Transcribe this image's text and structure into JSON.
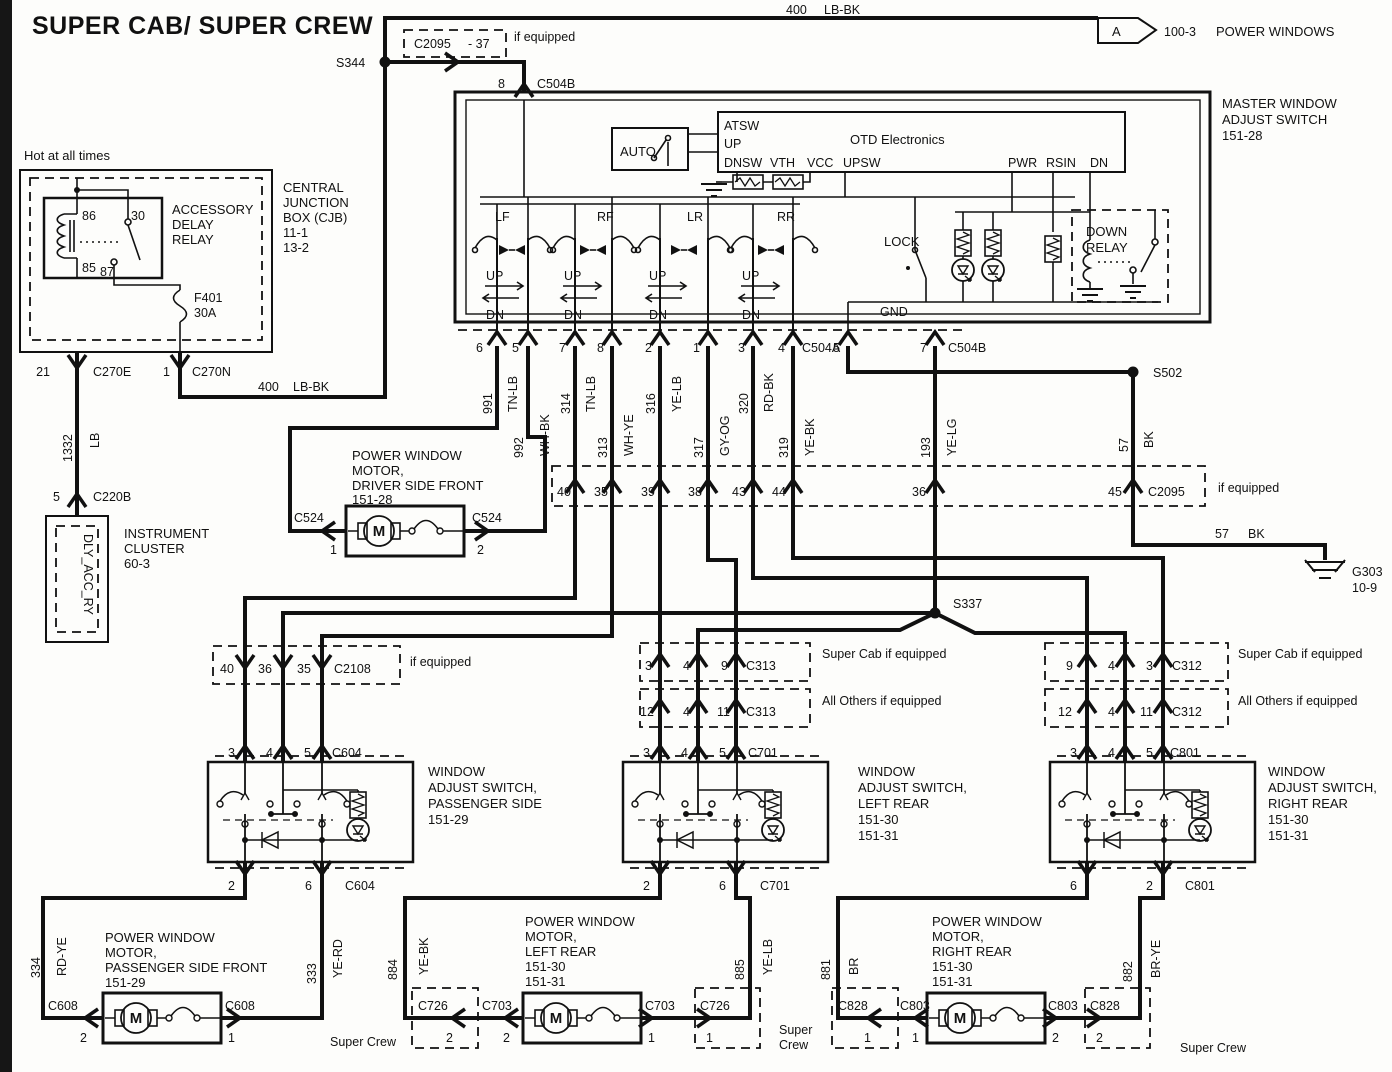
{
  "title": "SUPER CAB/ SUPER CREW",
  "phrases": {
    "hot": "Hot at all times",
    "if_equipped": "if equipped",
    "super_cab": "Super Cab if equipped",
    "all_others": "All Others if equipped",
    "super_crew": "Super Crew",
    "super": "Super",
    "crew": "Crew",
    "power_windows": "POWER WINDOWS",
    "flag": "A",
    "flag_ref": "100-3"
  },
  "splices": {
    "s344": "S344",
    "s502": "S502",
    "s337": "S337"
  },
  "grounds": {
    "g303": "G303",
    "g303_ref": "10-9"
  },
  "connectors": {
    "c2095": "C2095",
    "c2095_pin": "- 37",
    "c504a": "C504A",
    "c504b": "C504B",
    "c270e": "C270E",
    "c270n": "C270N",
    "c220b": "C220B",
    "c524": "C524",
    "c2108": "C2108",
    "c604": "C604",
    "c313": "C313",
    "c701": "C701",
    "c726": "C726",
    "c703": "C703",
    "c312": "C312",
    "c801": "C801",
    "c828": "C828",
    "c803": "C803",
    "c608": "C608"
  },
  "pins": {
    "p1": "1",
    "p2": "2",
    "p3": "3",
    "p4": "4",
    "p5": "5",
    "p6": "6",
    "p7": "7",
    "p8": "8",
    "p9": "9",
    "p11": "11",
    "p12": "12",
    "p21": "21",
    "p35": "35",
    "p36": "36",
    "p38": "38",
    "p39": "39",
    "p40": "40",
    "p43": "43",
    "p44": "44",
    "p45": "45"
  },
  "wires": {
    "w400": "400",
    "c400": "LB-BK",
    "w1332": "1332",
    "c1332": "LB",
    "w991": "991",
    "c991": "TN-LB",
    "w992": "992",
    "c992": "WH-BK",
    "w314": "314",
    "c314": "TN-LB",
    "w313": "313",
    "c313": "WH-YE",
    "w316": "316",
    "c316": "YE-LB",
    "w317": "317",
    "c317": "GY-OG",
    "w320": "320",
    "c320": "RD-BK",
    "w319": "319",
    "c319": "YE-BK",
    "w193": "193",
    "c193": "YE-LG",
    "w57": "57",
    "c57": "BK",
    "w334": "334",
    "c334": "RD-YE",
    "w333": "333",
    "c333": "YE-RD",
    "w884": "884",
    "c884": "YE-BK",
    "w885": "885",
    "c885": "YE-LB",
    "w881": "881",
    "c881": "BR",
    "w882": "882",
    "c882": "BR-YE"
  },
  "cjb": {
    "central": "CENTRAL",
    "junction": "JUNCTION",
    "box": "BOX (CJB)",
    "ref1": "11-1",
    "ref2": "13-2",
    "acc": "ACCESSORY",
    "delay": "DELAY",
    "relay": "RELAY",
    "p86": "86",
    "p30": "30",
    "p85": "85",
    "p87": "87",
    "fuse": "F401",
    "amps": "30A"
  },
  "cluster": {
    "l1": "INSTRUMENT",
    "l2": "CLUSTER",
    "ref": "60-3",
    "module": "DLY_ACC_RY"
  },
  "master": {
    "n1": "MASTER WINDOW",
    "n2": "ADJUST SWITCH",
    "ref": "151-28",
    "auto": "AUTO",
    "otd": "OTD Electronics",
    "atsw": "ATSW",
    "up": "UP",
    "dnsw": "DNSW",
    "vth": "VTH",
    "vcc": "VCC",
    "upsw": "UPSW",
    "pwr": "PWR",
    "rsin": "RSIN",
    "dn": "DN",
    "lf": "LF",
    "rf": "RF",
    "lr": "LR",
    "rr": "RR",
    "lock": "LOCK",
    "gnd": "GND",
    "down": "DOWN",
    "relay": "RELAY"
  },
  "sw": {
    "window": "WINDOW",
    "adjust": "ADJUST SWITCH,",
    "pass": "PASSENGER SIDE",
    "lr": "LEFT REAR",
    "rr": "RIGHT REAR",
    "r28": "151-28",
    "r29": "151-29",
    "r30": "151-30",
    "r31": "151-31"
  },
  "motor": {
    "l1": "POWER WINDOW",
    "l2": "MOTOR,",
    "driver": "DRIVER SIDE FRONT",
    "pass": "PASSENGER SIDE FRONT",
    "lr": "LEFT REAR",
    "rr": "RIGHT REAR",
    "m": "M"
  }
}
